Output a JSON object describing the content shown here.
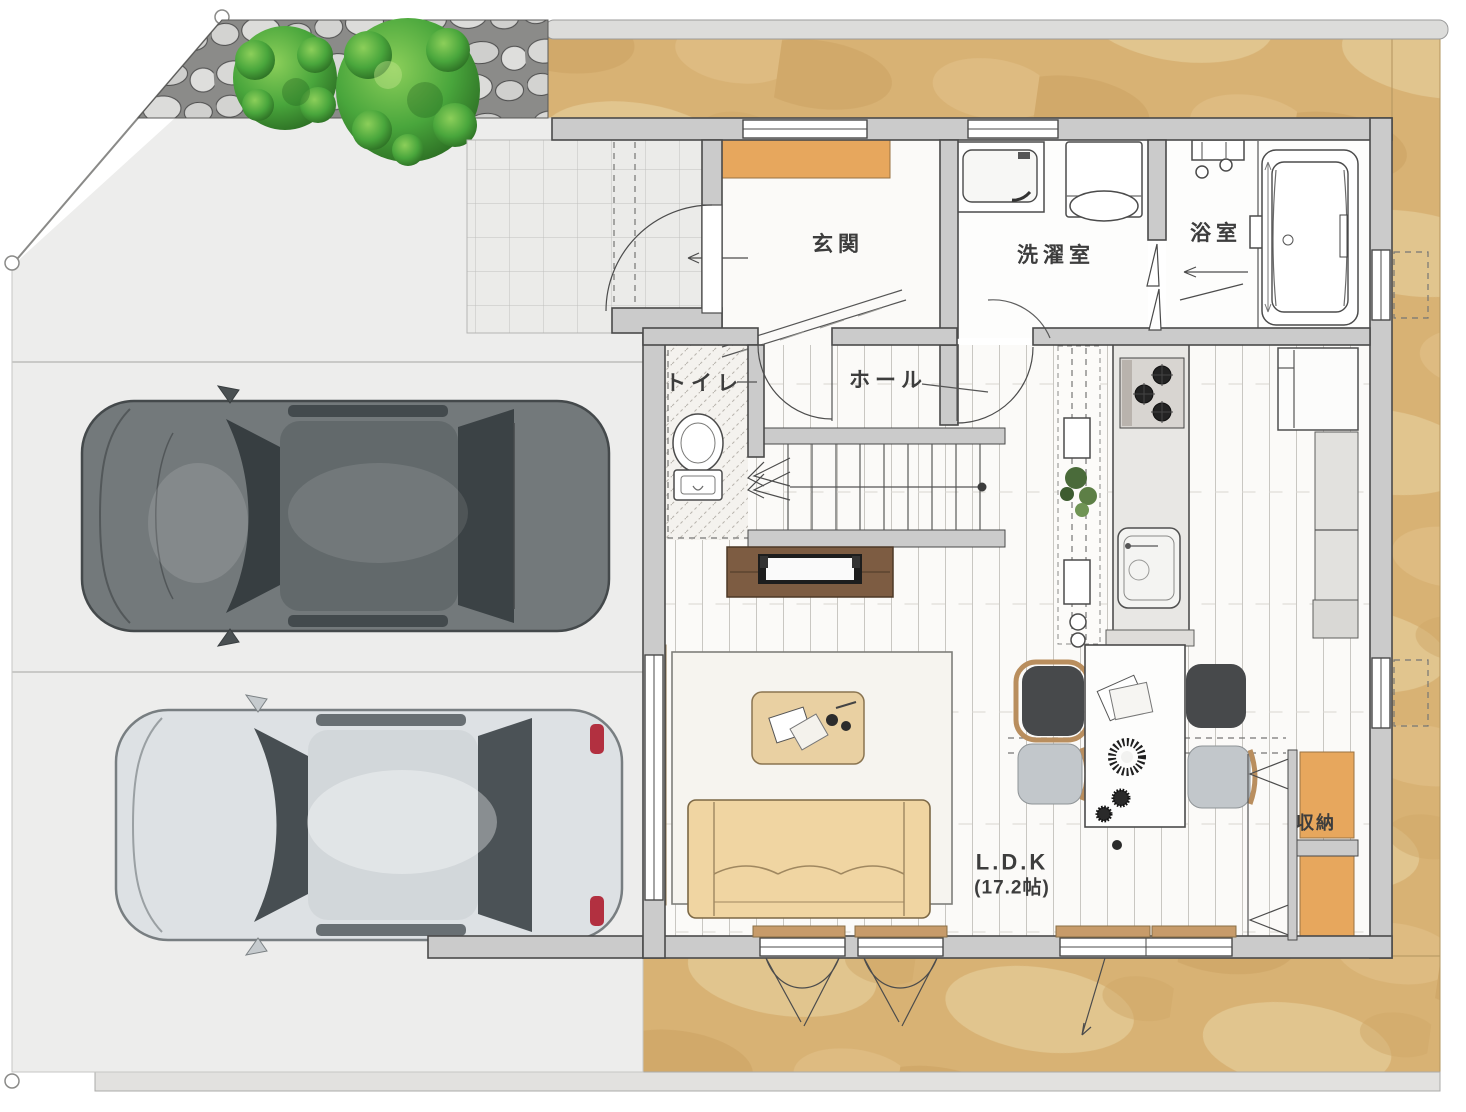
{
  "plan_title": "1F floor plan",
  "rooms": {
    "genkan": "玄関",
    "laundry": "洗濯室",
    "bath": "浴室",
    "toilet": "トイレ",
    "hall": "ホール",
    "storage": "収納",
    "ldk_name": "L.D.K",
    "ldk_size": "(17.2帖)"
  },
  "site": {
    "parking_spaces": 2,
    "trees": 2,
    "features": [
      "stone-wall",
      "tiled-approach",
      "driveway",
      "boundary-markers"
    ]
  },
  "colors": {
    "wall": "#cbcbcb",
    "wall-stroke": "#4a4a4a",
    "ground": "#d8b274",
    "drive": "#ededec",
    "floor": "#fbfaf8",
    "orange": "#e7a75d",
    "wood": "#c79b6a",
    "rug": "#f6f4ef",
    "sofa": "#f0d5a2",
    "tv-board": "#7d5c42",
    "chair-dark": "#47494b",
    "chair-light": "#c2c7cb",
    "car-dark": "#73797b",
    "car-silver": "#dde1e4",
    "tree": "#3f9334",
    "label": "#3d3d3d",
    "accent-red": "#b23040"
  }
}
